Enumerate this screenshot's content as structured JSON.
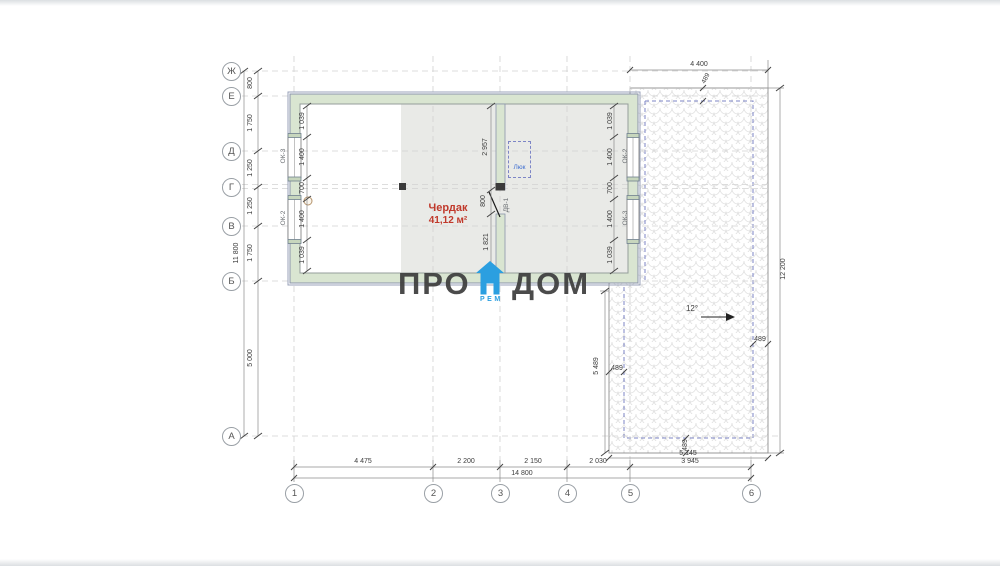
{
  "title": "attic floor plan",
  "axes": {
    "rows": [
      "Ж",
      "Е",
      "Д",
      "Г",
      "В",
      "Б",
      "А"
    ],
    "cols": [
      "1",
      "2",
      "3",
      "4",
      "5",
      "6"
    ]
  },
  "dims": {
    "left_chain": [
      "800",
      "1 750",
      "1 250",
      "1 250",
      "1 750"
    ],
    "left_lower": "5 000",
    "left_total": "11 800",
    "bottom_chain": [
      "4 475",
      "2 200",
      "2 150",
      "2 030",
      "3 945"
    ],
    "bottom_total": "14 800",
    "inner_left": [
      "1 039",
      "1 400",
      "700",
      "1 400",
      "1 039"
    ],
    "inner_right": [
      "1 039",
      "1 400",
      "700",
      "1 400",
      "1 039"
    ],
    "partition": [
      "2 957",
      "800",
      "1 821"
    ],
    "roof_top": "4 400",
    "roof_right": "12 200",
    "roof_left": "5 489",
    "roof_bottom": "5 145",
    "roof_offset_top": "489",
    "roof_offset_right": "489",
    "roof_offset_left": "489",
    "roof_offset_bottom": "489"
  },
  "labels": {
    "window_left_top": "ОК-3",
    "window_left_bottom": "ОК-2",
    "window_right_top": "ОК-2",
    "window_right_bottom": "ОК-3",
    "door": "ДВ-1",
    "hatch": "Люк",
    "room_name": "Чердак",
    "room_area": "41,12 м²",
    "slope": "12°"
  },
  "watermark": {
    "left": "ПРО",
    "right": "ДОМ",
    "sub": "РЕМ"
  },
  "colors": {
    "wall_fill": "#d9e5d1",
    "wall_edge": "#8a94ab",
    "interior_gray": "#e9eae7",
    "roof_dashed": "#7d85c6",
    "room_label_red": "#c0392b",
    "brand_blue": "#2b9fe0",
    "watermark_dark": "#3e3e3e"
  }
}
